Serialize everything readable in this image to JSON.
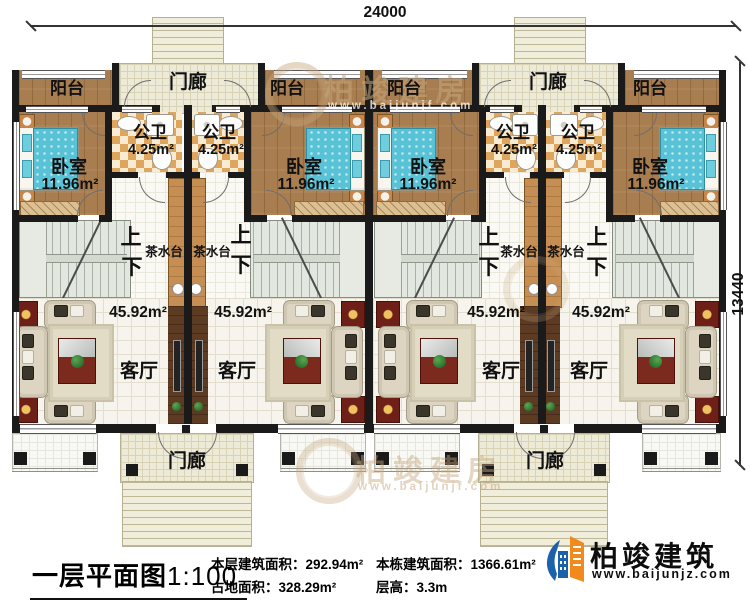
{
  "dimensions": {
    "top": "24000",
    "right": "13440"
  },
  "rooms": {
    "balcony": "阳台",
    "porch": "门廊",
    "bathroom": "公卫",
    "bathroom_area": "4.25m²",
    "bedroom": "卧室",
    "bedroom_area": "11.96m²",
    "living_room": "客厅",
    "living_room_area": "45.92m²",
    "tea_station": "茶水台",
    "stair_up": "上",
    "stair_down": "下"
  },
  "watermark": {
    "brand": "柏竣建房",
    "website": "www.baijunjf.com"
  },
  "legend": {
    "title": "一层平面图",
    "scale": "1:100",
    "stats": [
      {
        "label": "本层建筑面积：",
        "value": "292.94m²"
      },
      {
        "label": "占地面积：",
        "value": "328.29m²"
      },
      {
        "label": "本栋建筑面积：",
        "value": "1366.61m²"
      },
      {
        "label": "层高：",
        "value": "3.3m"
      }
    ],
    "logo": {
      "name": "柏竣建筑",
      "website": "www.baijunjz.com"
    }
  }
}
